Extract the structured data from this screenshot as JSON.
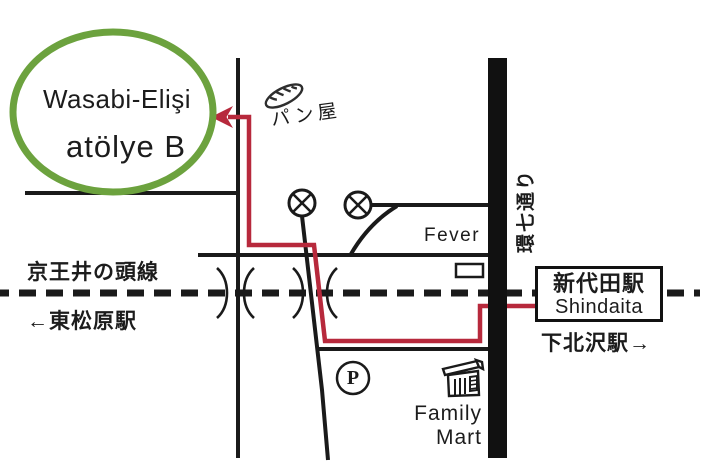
{
  "colors": {
    "accent_green": "#6CA23E",
    "route_red": "#B7293C",
    "ink": "#1A1A1A"
  },
  "destination": {
    "line1": "Wasabi-Elişi",
    "line2": "atölye B"
  },
  "bakery_label": "パン屋",
  "venue_label": "Fever",
  "kannana_road_label": "環七通り",
  "railway": {
    "line_name": "京王井の頭線",
    "west_station": "←東松原駅",
    "station_jp": "新代田駅",
    "station_en": "Shindaita",
    "east_station": "下北沢駅→"
  },
  "parking_label": "P",
  "family_mart": {
    "line1": "Family",
    "line2": "Mart"
  },
  "icons": {
    "bread": "bread-icon",
    "traffic_signal": "circled-x-signal-icon",
    "railroad_crossing": "paren-crossing-marks",
    "store": "family-mart-storefront-icon",
    "parking": "circled-p-icon",
    "route_arrow": "left-arrow-icon",
    "destination_ring": "green-circle-highlight"
  }
}
